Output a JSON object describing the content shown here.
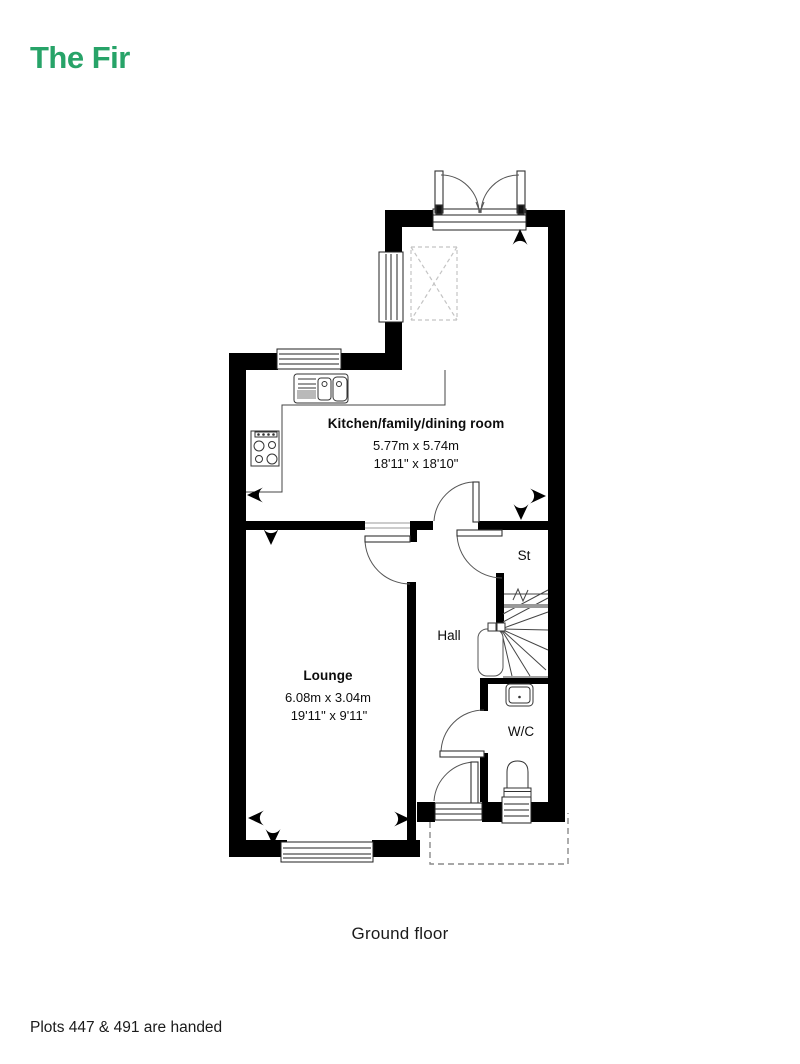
{
  "title": "The Fir",
  "floor_caption": "Ground floor",
  "footer_note": "Plots 447 & 491 are handed",
  "colors": {
    "brand_green": "#27a368",
    "wall": "#000000"
  },
  "plan": {
    "rooms": {
      "kitchen": {
        "name": "Kitchen/family/dining room",
        "metric": "5.77m x 5.74m",
        "imperial": "18'11\" x 18'10\""
      },
      "lounge": {
        "name": "Lounge",
        "metric": "6.08m x 3.04m",
        "imperial": "19'11\" x 9'11\""
      },
      "hall": {
        "name": "Hall"
      },
      "store": {
        "name": "St"
      },
      "wc": {
        "name": "W/C"
      }
    }
  }
}
